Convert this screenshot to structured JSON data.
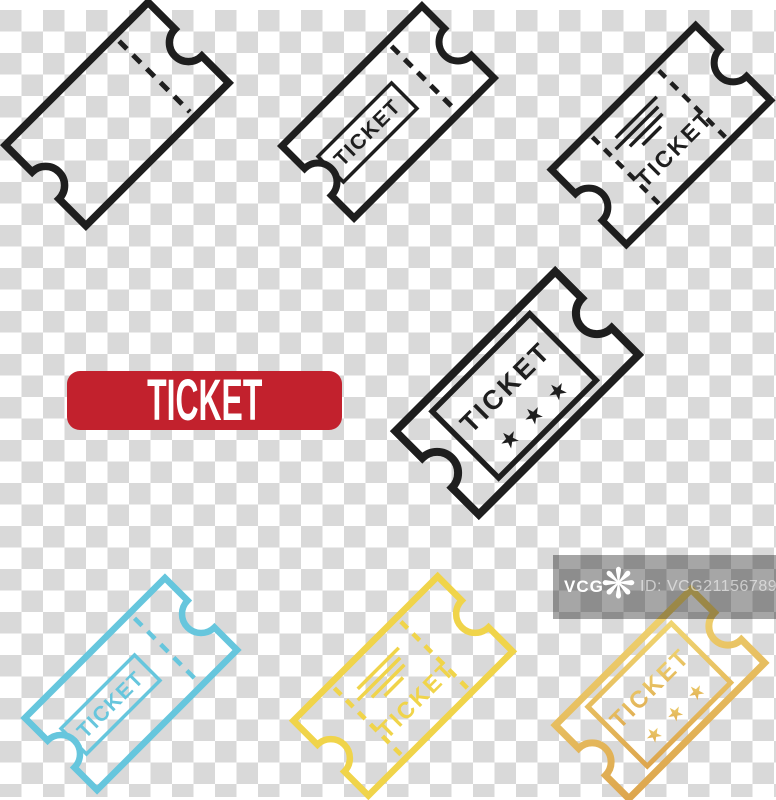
{
  "canvas": {
    "width": 776,
    "height": 800
  },
  "colors": {
    "ticket_black": "#1e1e1e",
    "ticket_blue": "#66c6dd",
    "ticket_yellow": "#f0d44a",
    "gold_light": "#f0d571",
    "gold_dark": "#dda64e",
    "button_red": "#c2212d",
    "button_text": "#ffffff",
    "checker_gray": "#d9d9d9",
    "watermark_overlay": "rgba(0,0,0,0.35)",
    "watermark_id_text": "rgba(255,255,255,0.55)"
  },
  "button": {
    "label": "TICKET"
  },
  "tickets": {
    "plain": {
      "description": "plain outline ticket with dashed stub line"
    },
    "boxed": {
      "label": "TICKET"
    },
    "lined": {
      "label": "TICKET"
    },
    "stars": {
      "label": "TICKET",
      "star_char": "★"
    },
    "blue": {
      "label": "TICKET"
    },
    "yellow": {
      "label": "TICKET"
    },
    "gold": {
      "label": "TICKET",
      "star_char": "★"
    }
  },
  "watermark": {
    "brand": "VCG",
    "logo_icon": "pinwheel-asterisk",
    "logo_glyph": "❋",
    "id_label": "ID: VCG211567896214"
  }
}
